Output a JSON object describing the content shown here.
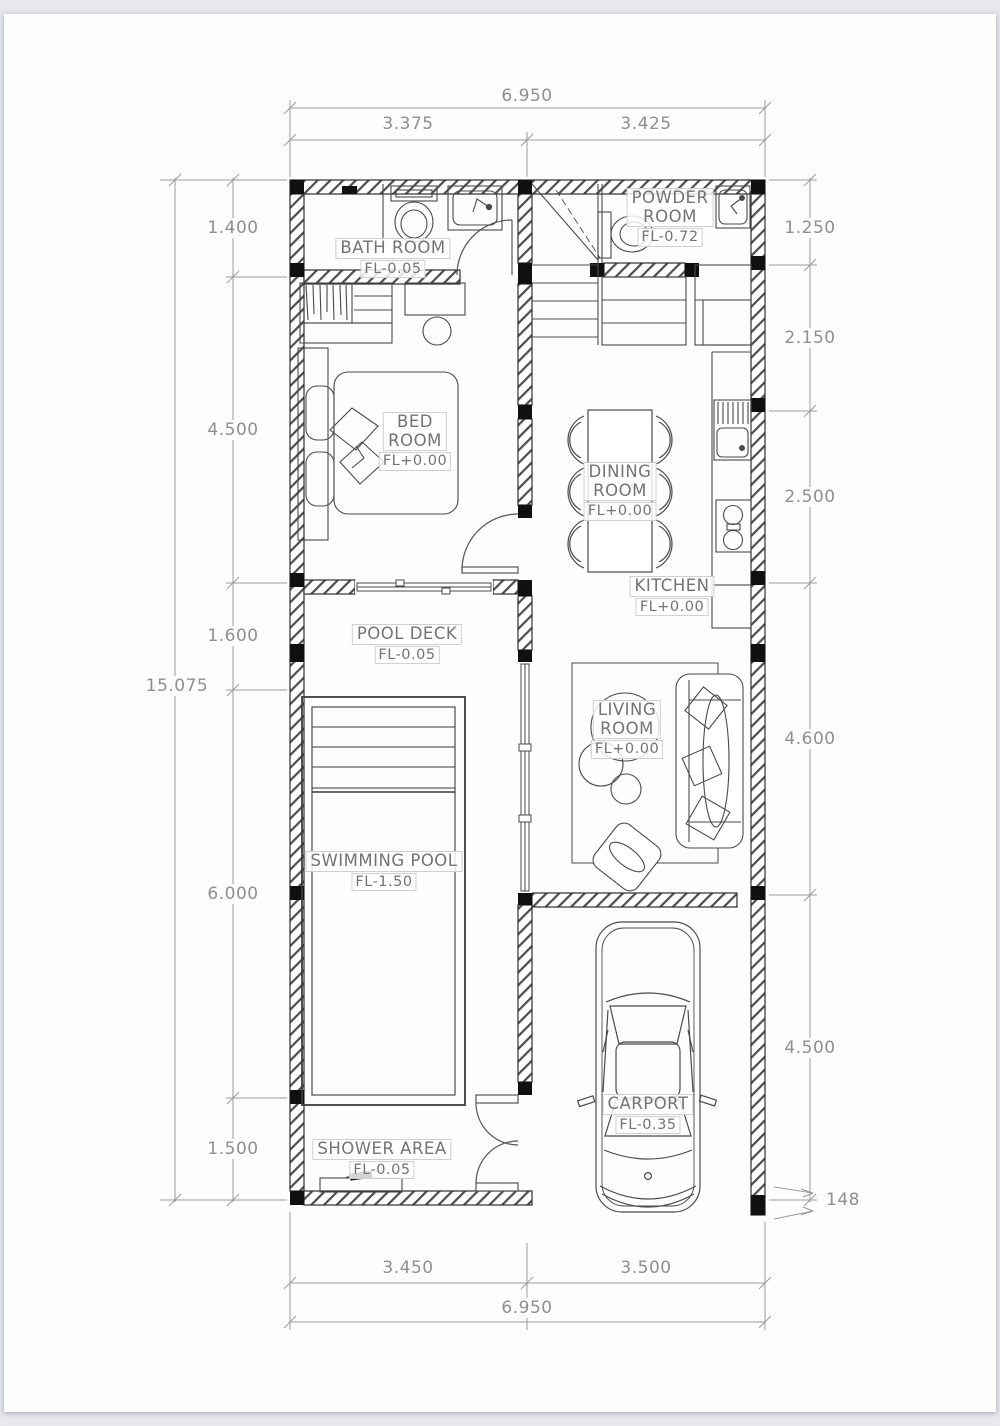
{
  "title": "House floor plan",
  "colors": {
    "paper": "#fdfdfe",
    "background": "#e7e8ed",
    "wall_line": "#2f2f2f",
    "furniture_line": "#4a4a4a",
    "dimension_text": "#8f8f8f",
    "label_text": "#737373",
    "column_fill": "#101010"
  },
  "rooms": {
    "bath": {
      "name": "BATH ROOM",
      "level": "FL-0.05"
    },
    "powder": {
      "name": "POWDER\nROOM",
      "level": "FL-0.72"
    },
    "bed": {
      "name": "BED\nROOM",
      "level": "FL+0.00"
    },
    "dining": {
      "name": "DINING\nROOM",
      "level": "FL+0.00"
    },
    "kitchen": {
      "name": "KITCHEN",
      "level": "FL+0.00"
    },
    "pool_deck": {
      "name": "POOL DECK",
      "level": "FL-0.05"
    },
    "living": {
      "name": "LIVING\nROOM",
      "level": "FL+0.00"
    },
    "pool": {
      "name": "SWIMMING POOL",
      "level": "FL-1.50"
    },
    "shower": {
      "name": "SHOWER AREA",
      "level": "FL-0.05"
    },
    "carport": {
      "name": "CARPORT",
      "level": "FL-0.35"
    }
  },
  "dimensions": {
    "top": {
      "overall": "6.950",
      "seg1": "3.375",
      "seg2": "3.425"
    },
    "bottom": {
      "overall": "6.950",
      "seg1": "3.450",
      "seg2": "3.500"
    },
    "left": {
      "overall": "15.075",
      "seg1": "1.400",
      "seg2": "4.500",
      "seg3": "1.600",
      "seg4": "6.000",
      "seg5": "1.500"
    },
    "right": {
      "seg1": "1.250",
      "seg2": "2.150",
      "seg3": "2.500",
      "seg4": "4.600",
      "seg5": "4.500",
      "wall_thickness": "148"
    }
  }
}
